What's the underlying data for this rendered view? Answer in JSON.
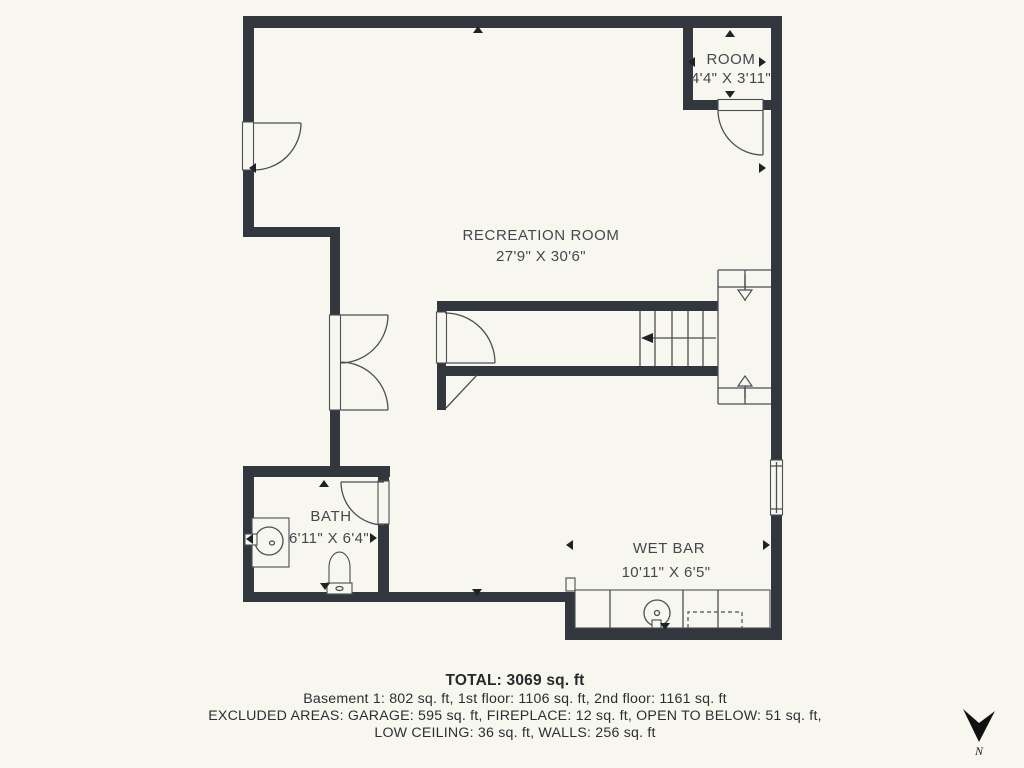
{
  "plan": {
    "rooms": [
      {
        "name": "RECREATION ROOM",
        "dims": "27'9\" X 30'6\""
      },
      {
        "name": "ROOM",
        "dims": "4'4\" X 3'11\""
      },
      {
        "name": "BATH",
        "dims": "6'11\" X 6'4\""
      },
      {
        "name": "WET BAR",
        "dims": "10'11\" X 6'5\""
      }
    ],
    "compass": {
      "label": "N"
    }
  },
  "footer": {
    "total": "TOTAL: 3069 sq. ft",
    "floors": "Basement 1: 802 sq. ft, 1st floor: 1106 sq. ft, 2nd floor: 1161 sq. ft",
    "excluded_1": "EXCLUDED AREAS: GARAGE: 595 sq. ft, FIREPLACE: 12 sq. ft, OPEN TO BELOW: 51 sq. ft,",
    "excluded_2": "LOW CEILING: 36 sq. ft, WALLS: 256 sq. ft"
  },
  "colors": {
    "background": "#f8f7ef",
    "wall": "#31373d",
    "thin_line": "#4a4f55",
    "label_text": "#43484e",
    "footer_text": "#2b2f33",
    "north_arrow": "#111111"
  }
}
